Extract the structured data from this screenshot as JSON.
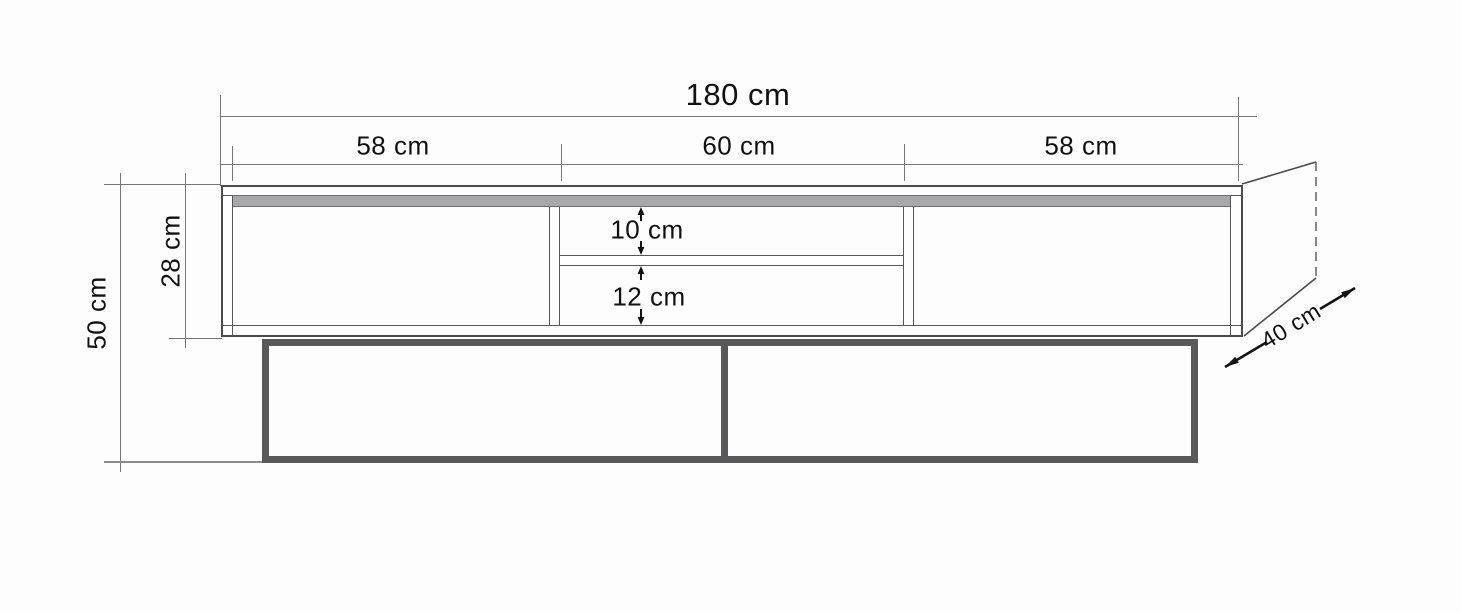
{
  "diagram": {
    "labels": {
      "total_width": "180 cm",
      "section_left": "58 cm",
      "section_middle": "60 cm",
      "section_right": "58 cm",
      "overall_height": "50 cm",
      "cabinet_height": "28 cm",
      "niche_upper": "10 cm",
      "niche_lower": "12 cm",
      "depth": "40 cm"
    },
    "colors": {
      "background": "#fdfdfd",
      "outline": "#4a4a4f",
      "dimension_line": "#76767a",
      "top_strip_fill": "#a8a8ac",
      "base_frame": "#59595c",
      "text": "#111111"
    }
  }
}
